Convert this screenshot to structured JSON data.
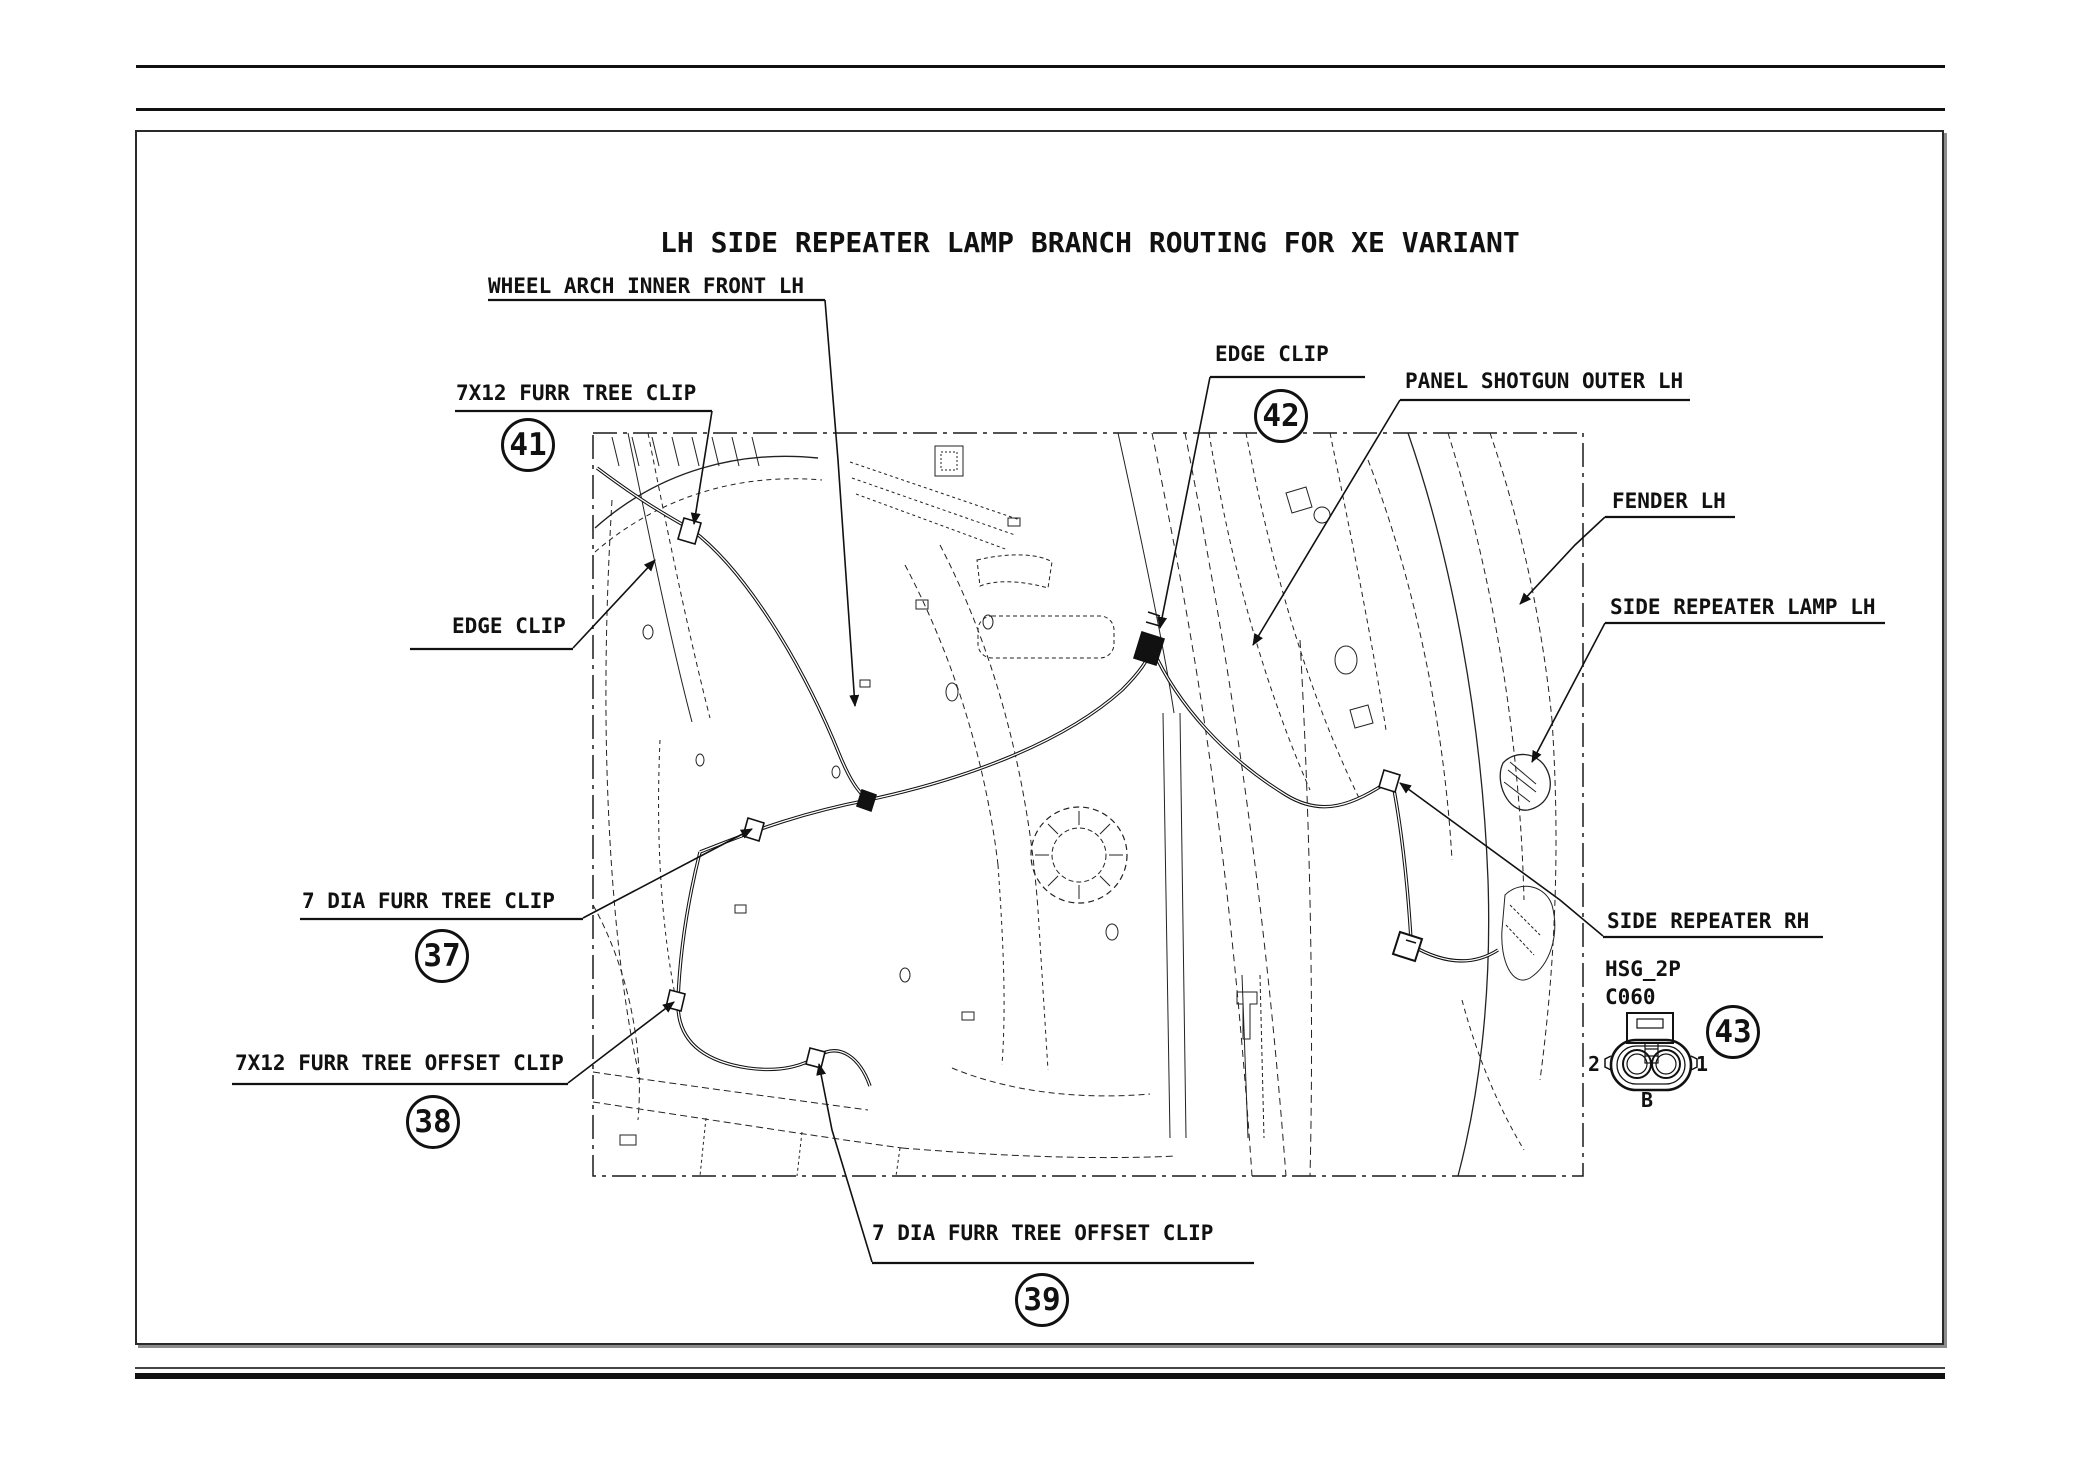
{
  "title": "LH SIDE REPEATER LAMP BRANCH ROUTING FOR XE VARIANT",
  "labels": {
    "wheel_arch": "WHEEL ARCH INNER FRONT LH",
    "furr_tree_7x12": "7X12 FURR TREE CLIP",
    "edge_clip_left": "EDGE CLIP",
    "edge_clip_top": "EDGE CLIP",
    "panel_shotgun": "PANEL SHOTGUN OUTER LH",
    "fender": "FENDER LH",
    "side_repeater_lamp": "SIDE REPEATER LAMP LH",
    "side_repeater_rh": "SIDE REPEATER RH",
    "furr_tree_7dia": "7 DIA FURR TREE CLIP",
    "furr_tree_offset_7x12": "7X12 FURR TREE OFFSET CLIP",
    "furr_tree_offset_7dia": "7 DIA FURR TREE OFFSET CLIP"
  },
  "balloons": [
    {
      "number": "41"
    },
    {
      "number": "42"
    },
    {
      "number": "37"
    },
    {
      "number": "38"
    },
    {
      "number": "39"
    },
    {
      "number": "43"
    }
  ],
  "connector": {
    "housing": "HSG_2P",
    "code": "C060",
    "pin_left": "2",
    "pin_right": "1",
    "cavity": "B"
  },
  "colors": {
    "line": "#1a1a1a",
    "background": "#ffffff"
  }
}
